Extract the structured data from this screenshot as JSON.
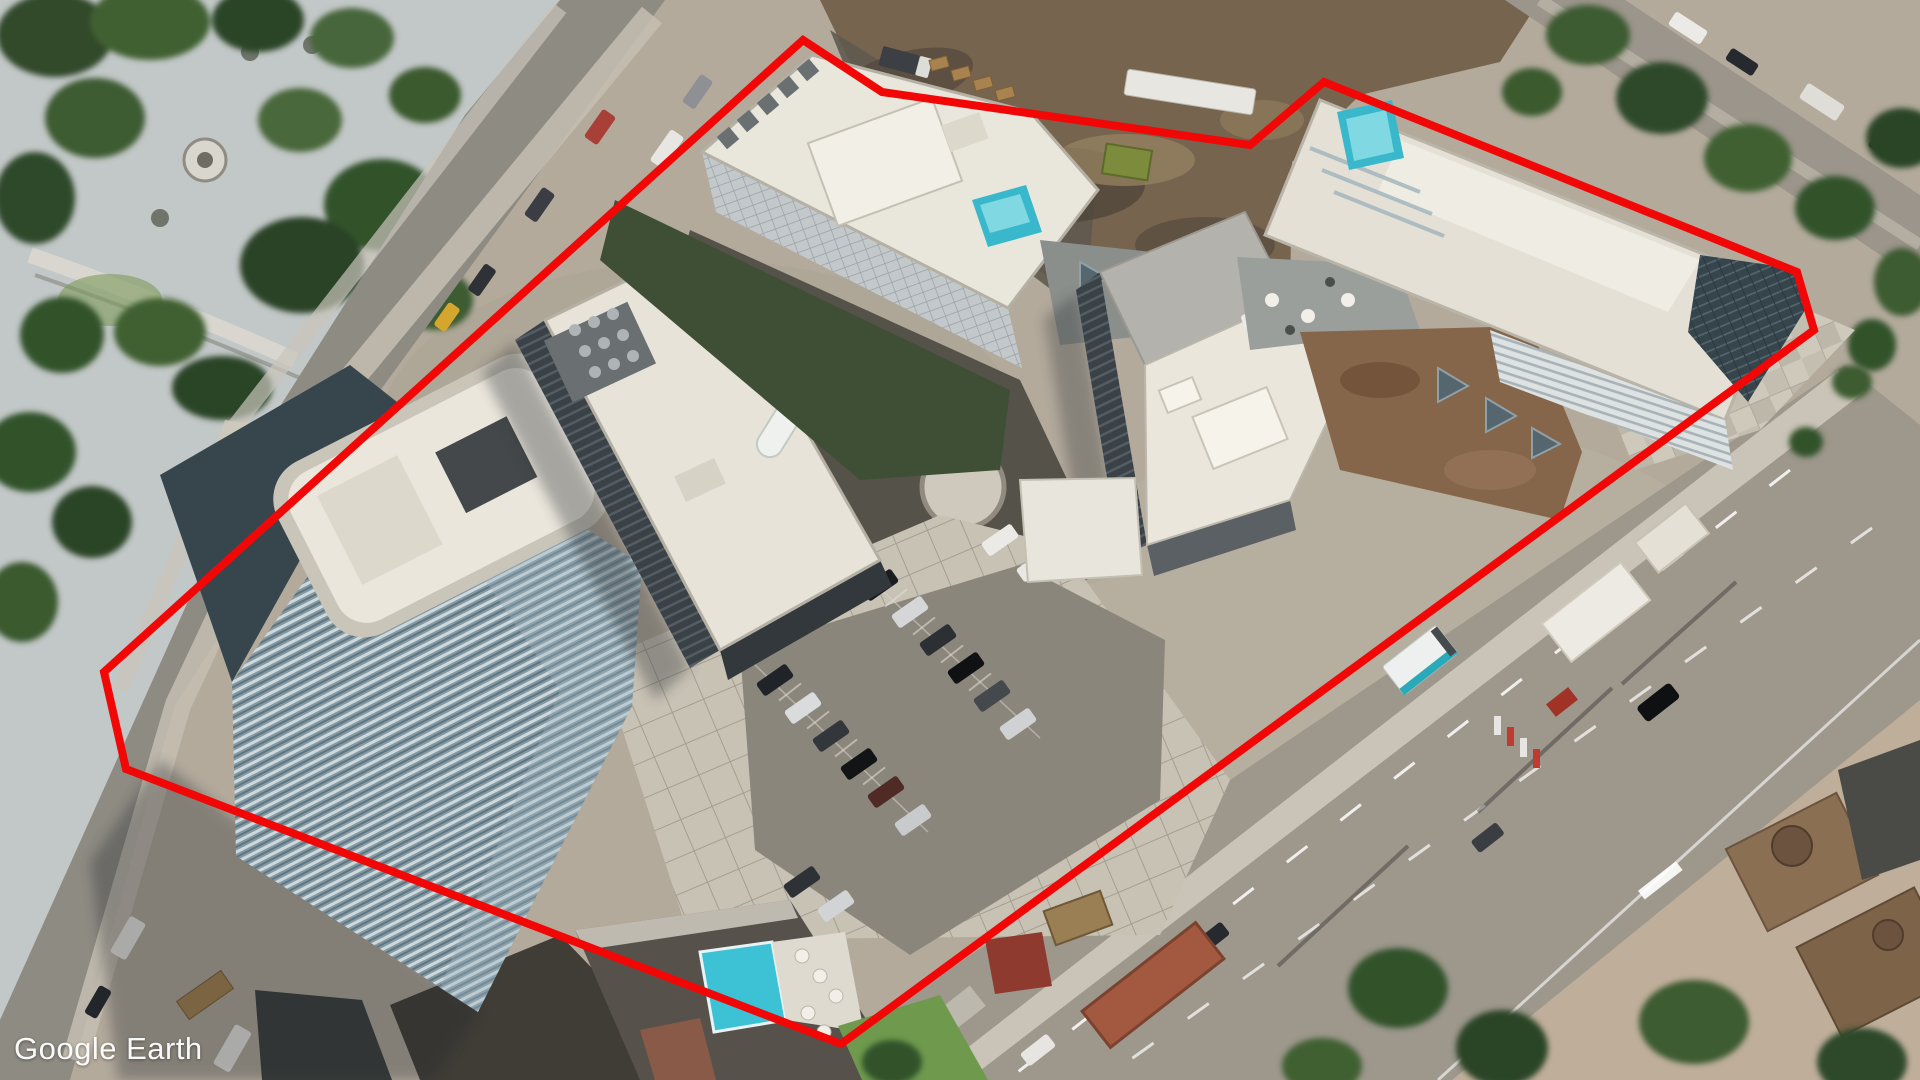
{
  "app": {
    "watermark": "Google Earth"
  },
  "annotation": {
    "type": "site-boundary-polygon",
    "color": "#f20707",
    "stroke_width_px": 8,
    "points": [
      [
        803,
        40
      ],
      [
        882,
        92
      ],
      [
        1250,
        145
      ],
      [
        1324,
        82
      ],
      [
        1797,
        272
      ],
      [
        1814,
        330
      ],
      [
        841,
        1044
      ],
      [
        126,
        769
      ],
      [
        104,
        672
      ]
    ]
  },
  "scene": {
    "view": "oblique-aerial-satellite",
    "description": "City block with five white-roofed residential towers outlined in red, central surface parking, paved plazas, tree-filled park at top-left, dirt construction site at top-center, and a wide multi-lane arterial road at bottom-right.",
    "palette": {
      "pavement": "#b6ad9f",
      "road_asphalt": "#9d978c",
      "park_plaza": "#c6cbcb",
      "tree_green": "#3f5a33",
      "lawn_green": "#6f9a4e",
      "dirt_brown": "#77644f",
      "roof_white": "#eae6dc",
      "glass_dark": "#36444c",
      "pool_teal": "#38b8ca",
      "rust_roof": "#a2593f"
    },
    "features": [
      {
        "id": "park",
        "position": "top-left"
      },
      {
        "id": "left-street",
        "position": "left edge, diagonal"
      },
      {
        "id": "construction-site",
        "position": "top-center"
      },
      {
        "id": "arterial-road",
        "position": "bottom-right, diagonal"
      },
      {
        "id": "side-street",
        "position": "top-right corner"
      },
      {
        "id": "historic-block",
        "position": "bottom-right corner"
      },
      {
        "id": "glass-tower",
        "position": "bottom-left",
        "roof": "white racetrack",
        "facade": "blue glass"
      },
      {
        "id": "west-midrise",
        "position": "center-left",
        "roof": "white + HVAC + oval pool"
      },
      {
        "id": "north-tower",
        "position": "top-center",
        "rooftop_pool": "#38b8ca"
      },
      {
        "id": "center-midrise",
        "position": "center-right",
        "roof": "gray + white"
      },
      {
        "id": "east-tower",
        "position": "top-right",
        "rooftop_pool": "#38b8ca",
        "roof_garden": true
      },
      {
        "id": "south-podium",
        "position": "bottom-center",
        "rooftop_pool": "#3cc2d4"
      },
      {
        "id": "parking-lot",
        "position": "center",
        "cars": 15
      },
      {
        "id": "central-circle-plaza",
        "position": "center"
      }
    ]
  }
}
